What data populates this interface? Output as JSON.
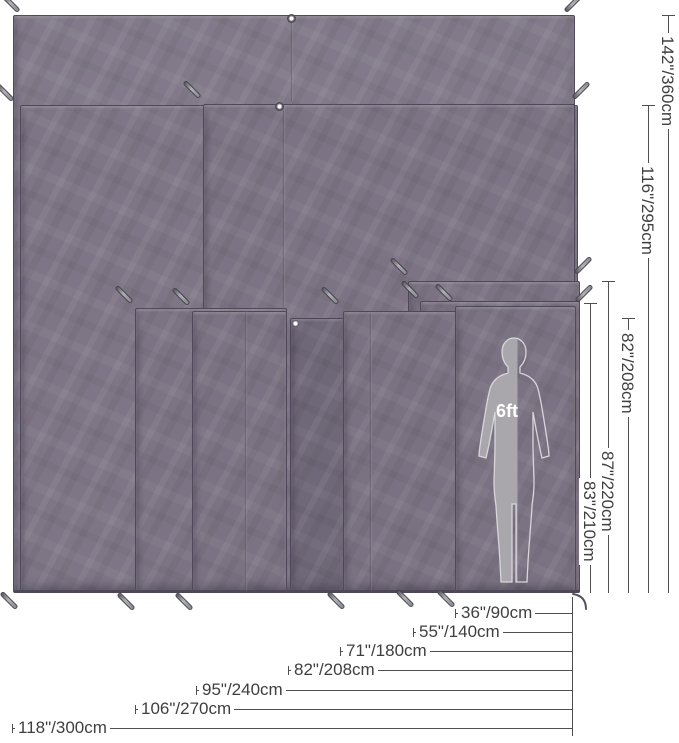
{
  "diagram": {
    "description": "Tarp footprint size comparison with overlapping sheets, dimension lines and a human figure for scale",
    "colors": {
      "tarp": "#7f7787",
      "tarp_dark_sliver": "#6f6878",
      "dimension_line": "#4f4f4f",
      "label_text": "#3f3f3f",
      "silhouette_fill": "#a9a7ac",
      "silhouette_outline": "#d8d6db",
      "background": "#ffffff"
    },
    "heights": [
      {
        "id": "h-142",
        "label": "142\"/360cm"
      },
      {
        "id": "h-116",
        "label": "116\"/295cm"
      },
      {
        "id": "h-82",
        "label": "82\"/208cm"
      },
      {
        "id": "h-87",
        "label": "87\"/220cm"
      },
      {
        "id": "h-83",
        "label": "83\"/210cm"
      }
    ],
    "widths": [
      {
        "id": "w-36",
        "label": "36\"/90cm"
      },
      {
        "id": "w-55",
        "label": "55\"/140cm"
      },
      {
        "id": "w-71",
        "label": "71\"/180cm"
      },
      {
        "id": "w-82",
        "label": "82\"/208cm"
      },
      {
        "id": "w-95",
        "label": "95\"/240cm"
      },
      {
        "id": "w-106",
        "label": "106\"/270cm"
      },
      {
        "id": "w-118",
        "label": "118\"/300cm"
      }
    ],
    "scale_reference": {
      "label": "6ft"
    }
  }
}
